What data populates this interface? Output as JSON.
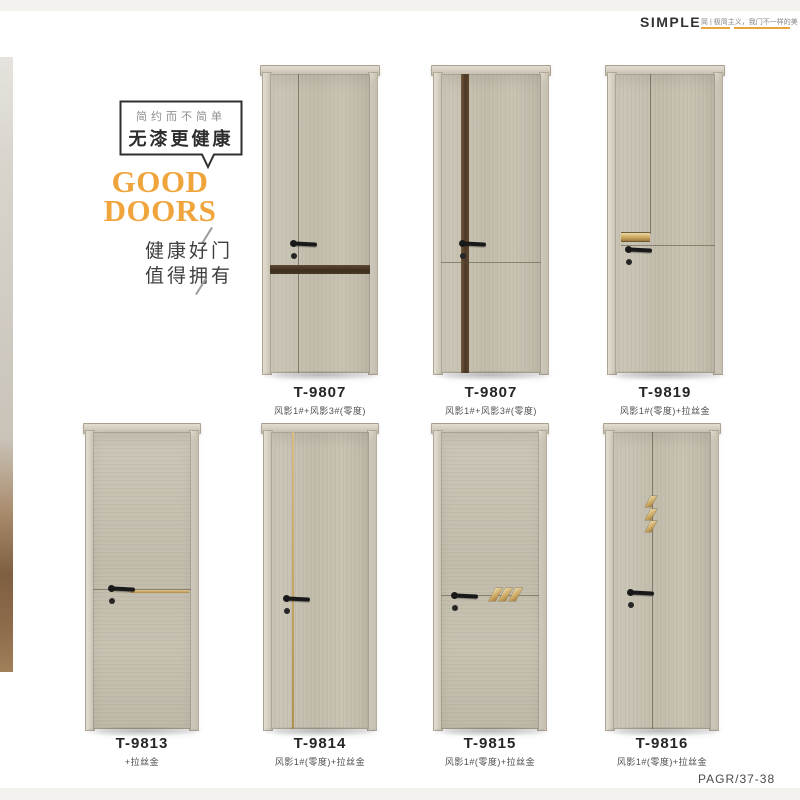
{
  "header": {
    "brand": "SIMPLE",
    "tagline": "简 | 极简主义，我门不一样的美"
  },
  "intro": {
    "bubble_small": "简约而不简单",
    "bubble_big": "无漆更健康",
    "title_line1": "GOOD",
    "title_line2": "DOORS",
    "slogan_line1": "健康好门",
    "slogan_line2": "值得拥有"
  },
  "products": [
    {
      "model": "T-9807",
      "finish": "风影1#+风影3#(零度)",
      "design": "vertical-groove-with-dark-horizontal-band"
    },
    {
      "model": "T-9807",
      "finish": "风影1#+风影3#(零度)",
      "design": "dark-vertical-stripe-with-horizontal-groove"
    },
    {
      "model": "T-9819",
      "finish": "风影1#(零度)+拉丝金",
      "design": "vertical-groove-with-gold-bar-accent"
    },
    {
      "model": "T-9813",
      "finish": "+拉丝金",
      "design": "horizontal-groove-with-gold-inlay"
    },
    {
      "model": "T-9814",
      "finish": "风影1#(零度)+拉丝金",
      "design": "vertical-gold-inlay-line"
    },
    {
      "model": "T-9815",
      "finish": "风影1#(零度)+拉丝金",
      "design": "horizontal-groove-with-three-gold-slashes"
    },
    {
      "model": "T-9816",
      "finish": "风影1#(零度)+拉丝金",
      "design": "vertical-groove-with-three-gold-slashes"
    }
  ],
  "footer": {
    "page_ref": "PAGR/37-38"
  },
  "colors": {
    "accent_gold": "#e9a43c",
    "stripe_brown": "#4a3724",
    "door_greige": "#c6c0b1"
  }
}
